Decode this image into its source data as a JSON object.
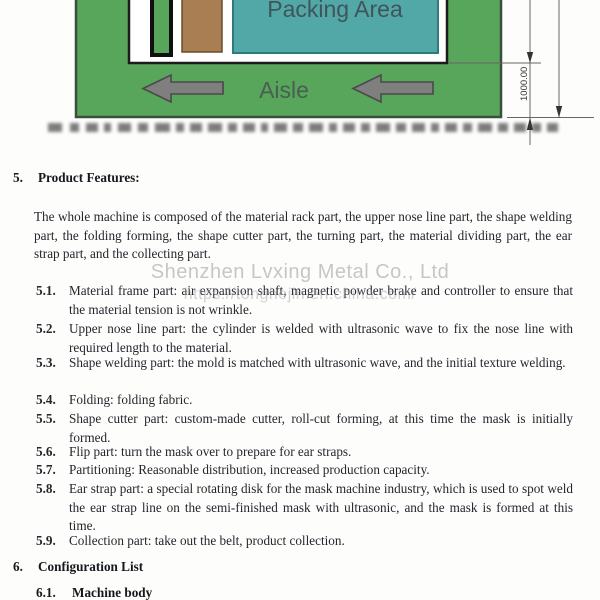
{
  "diagram": {
    "packing_area_label": "Packing Area",
    "aisle_label": "Aisle",
    "dimension_label": "1000.00",
    "colors": {
      "floor_green": "#58a55c",
      "packing_teal": "#52a7a7",
      "rack_brown": "#a87e52",
      "arrow_gray": "#7f7f7f",
      "diagram_text": "#3f545c"
    }
  },
  "watermark": {
    "line1": "Shenzhen Lvxing Metal Co., Ltd",
    "line2": "https://tonghejin.en.china.com/"
  },
  "sections": {
    "features": {
      "number": "5.",
      "title": "Product Features:",
      "intro": "The whole machine is composed of the material rack part, the upper nose line part, the shape welding part, the folding forming, the shape cutter part, the turning part, the material dividing part, the ear strap part, and the collecting part.",
      "items": [
        {
          "number": "5.1.",
          "text": "Material frame part: air expansion shaft, magnetic powder brake and controller to ensure that the material tension is not wrinkle."
        },
        {
          "number": "5.2.",
          "text": "Upper nose line part: the cylinder is welded with ultrasonic wave to fix the nose line with required length to the material."
        },
        {
          "number": "5.3.",
          "text": "Shape welding part: the mold is matched with ultrasonic wave, and the initial texture welding."
        },
        {
          "number": "5.4.",
          "text": "Folding: folding fabric."
        },
        {
          "number": "5.5.",
          "text": "Shape cutter part: custom-made cutter, roll-cut forming, at this time the mask is initially formed."
        },
        {
          "number": "5.6.",
          "text": "Flip part: turn the mask over to prepare for ear straps."
        },
        {
          "number": "5.7.",
          "text": "Partitioning: Reasonable distribution, increased production capacity."
        },
        {
          "number": "5.8.",
          "text": "Ear strap part: a special rotating disk for the mask machine industry, which is used to spot weld the ear strap line on the semi-finished mask with ultrasonic, and the mask is formed at this time."
        },
        {
          "number": "5.9.",
          "text": "Collection part: take out the belt, product collection."
        }
      ]
    },
    "configuration": {
      "number": "6.",
      "title": "Configuration List",
      "sub_number": "6.1.",
      "sub_title": "Machine body"
    }
  }
}
